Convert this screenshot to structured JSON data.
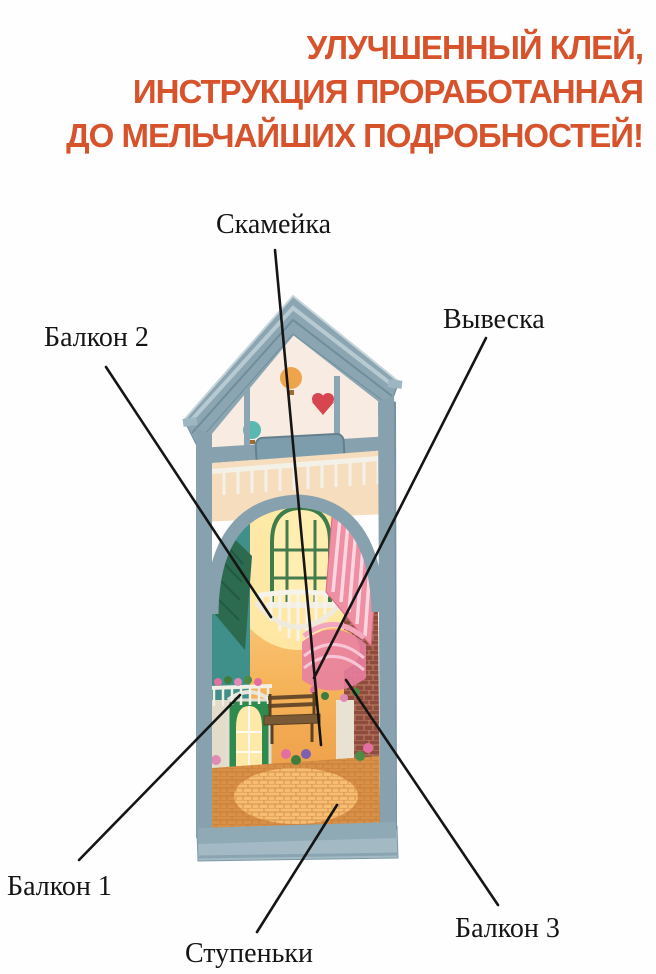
{
  "header": {
    "lines": [
      "УЛУЧШЕННЫЙ КЛЕЙ,",
      "ИНСТРУКЦИЯ ПРОРАБОТАННАЯ",
      "ДО МЕЛЬЧАЙШИХ ПОДРОБНОСТЕЙ!"
    ],
    "color": "#d6532c"
  },
  "callouts": {
    "bench": "Скамейка",
    "balcony2": "Балкон 2",
    "sign": "Вывеска",
    "balcony1": "Балкон 1",
    "steps": "Ступеньки",
    "balcony3": "Балкон 3"
  },
  "photo": {
    "subject": "DIY miniature book-nook house: slatted blue-grey roof, glass attic with hot-air balloons, blank name plate, lit alley with arched window, white balcony, green door, bench, pink round balcony, brick wall and steps",
    "colors": {
      "roof_frame": "#87a2ae",
      "roof_light": "#b7c9d1",
      "interior_glow": "#ffe29a",
      "wall_yellow": "#f2a93e",
      "teal_wall": "#3f8f8a",
      "green_awning": "#2d6b50",
      "pink_awning": "#ef8fa4",
      "brick": "#8e4c3e",
      "base": "#a3bac5",
      "leader_line": "#151515"
    }
  }
}
